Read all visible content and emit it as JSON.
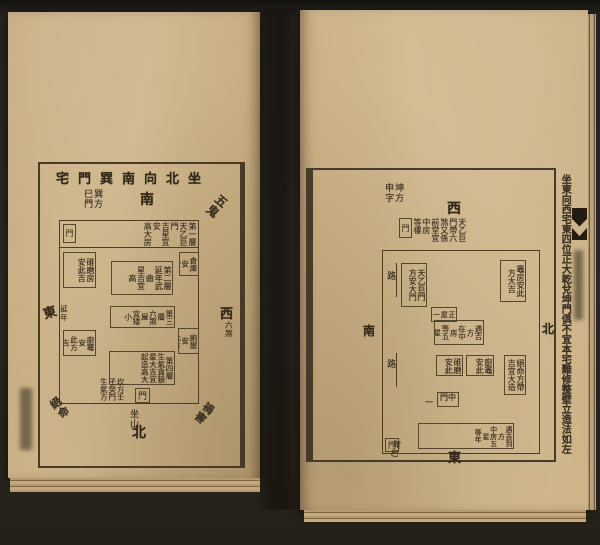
{
  "scene": {
    "background": "#272420",
    "paper": "#cbb185",
    "ink": "#3a2f22"
  },
  "left_page": {
    "title": "坐北向南巽門宅",
    "label_south": "南",
    "label_north": "北",
    "label_east": "東",
    "label_west": "西",
    "note_east": "延年",
    "note_west": "六煞",
    "corner_gate": "巽方\n巳門",
    "corner_sw": "五鬼",
    "corner_ne": "絕命",
    "corner_nw": "禍害",
    "gate_char": "門",
    "top_bar": "第一層\n天乙巨門\n吉星宜安\n高大房",
    "room_second": "第二層\n延年武曲\n星吉宜高",
    "room_third": "第三層\n六煞屋\n宜矮小",
    "room_fourth": "第四層\n生氣貪狼\n星大吉宜\n起造高大",
    "side_left_upper": "碓磨房\n安此吉",
    "side_left_lower": "廚竈安\n此方吉",
    "side_right_upper": "倉庫安\n此方",
    "side_right_lower": "廁屋安\n此方",
    "bottom_note": "坎方壬\n子癸門\n生氣方",
    "bottom_gate_char": "門",
    "sitting_label": "坐山"
  },
  "right_page": {
    "margin_note": "坐東向西宅東四位正大乾兌坤門俱不宜本宅難修整壁立造法如左",
    "label_west": "西",
    "label_south": "南",
    "label_north": "北",
    "label_east": "東",
    "gate_label": "坤方\n申字",
    "gate_char": "門",
    "west_note": "天乙巨\n門帶六\n煞又係\n前堂宜\n中房\n等樓",
    "road_label": "路",
    "box_inner_gate": "天乙巨門\n方安大門",
    "box_upper_right": "竈房安此\n方大吉",
    "box_center_small": "正屋\n一間",
    "box_center": "遇吉方\n在中房\n等五星\n年",
    "box_mid_gate": "中門",
    "dash": "一",
    "box_bottom_a": "碓磨\n安此",
    "box_bottom_b": "廚竈\n安此",
    "box_right_lower": "絕命方帶\n吉宜大造",
    "box_bottom_bar": "遇吉到方\n中房五星\n等年",
    "bottom_gate_char": "門",
    "bottom_gate_note": "巽巳"
  }
}
